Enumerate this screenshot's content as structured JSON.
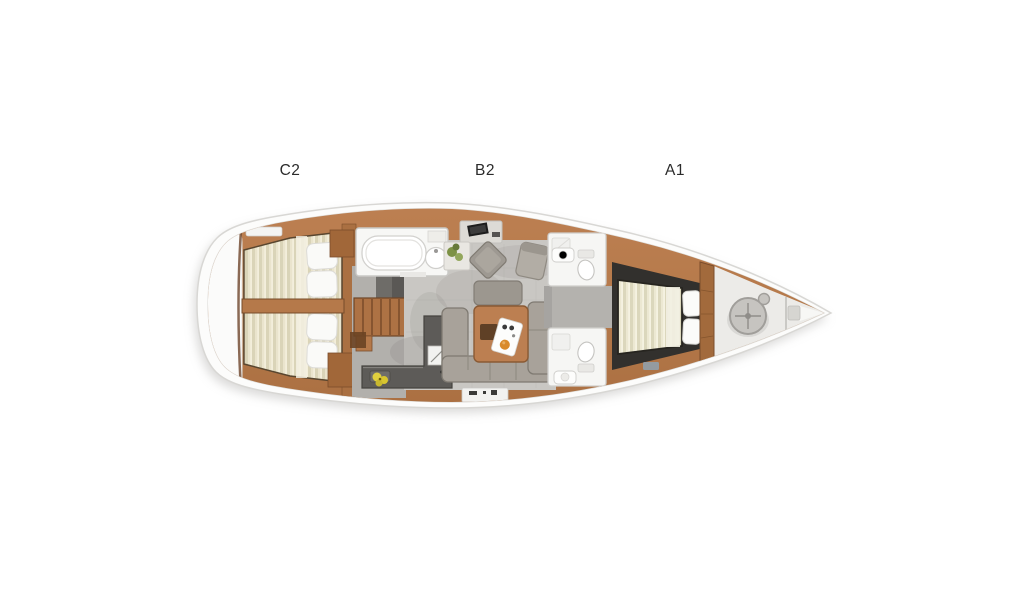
{
  "page": {
    "background_color": "#ffffff"
  },
  "plan": {
    "type": "sailing-yacht-interior-deck-plan",
    "labels": [
      {
        "text": "C2"
      },
      {
        "text": "B2"
      },
      {
        "text": "A1"
      }
    ],
    "regions": [
      "stern-platform",
      "aft-cabin-c2-twin-double-berths",
      "companionway-stairs",
      "aft-head-with-bathtub",
      "nav-station",
      "saloon-b2-u-sofa-and-table",
      "galley-l-counter",
      "mid-head-port",
      "mid-head-starboard",
      "forward-cabin-a1-island-berth",
      "bow-sail-locker-windlass"
    ],
    "colors": {
      "hull": "#fcfcfb",
      "hull_outline": "#d8d7d4",
      "wood": "#b5794a",
      "wood_dark": "#7b4d2b",
      "mattress": "#ece8d2",
      "mattress_stripe": "#dbd7bc",
      "floor_gray": "#c9c7c3",
      "corridor_gray": "#b4b2ae",
      "cabin_floor_dark": "#32302d",
      "galley_counter": "#5d5b58",
      "sofa_gray": "#a8a29a",
      "fixture_white": "#f7f7f5",
      "accent_fruit_orange": "#d98a2b",
      "accent_flower_yellow": "#e0cf3e",
      "accent_plant_green": "#7d9246",
      "label_text": "#2b2b2b"
    }
  }
}
